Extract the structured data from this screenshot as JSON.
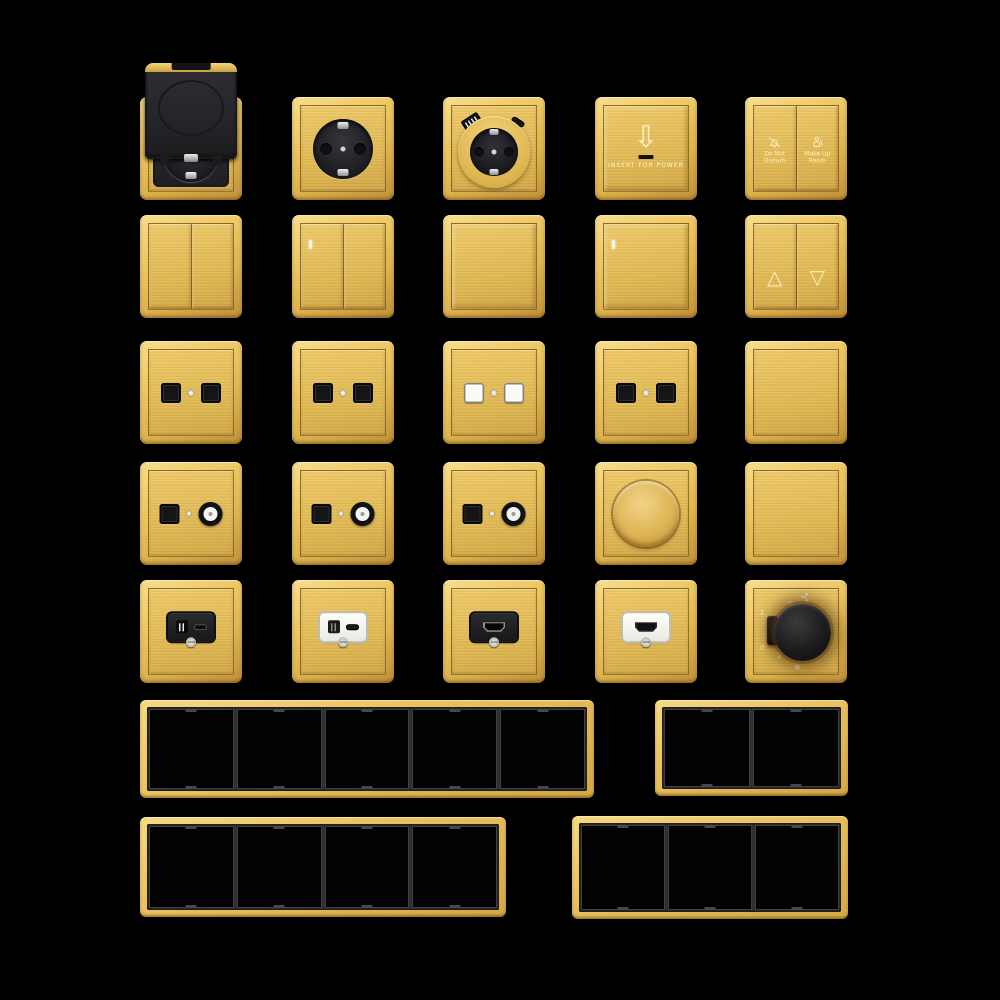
{
  "scene": {
    "background": "#000000"
  },
  "palette": {
    "gold_light": "#f6d87e",
    "gold": "#e3bc57",
    "gold_deep": "#c39539",
    "part_black": "#1c1c1e",
    "part_white": "#f5f5f2",
    "frame_divider": "#303033"
  },
  "products": {
    "row1": [
      {
        "id": "flip-cover-socket"
      },
      {
        "id": "schuko-socket"
      },
      {
        "id": "schuko-usb-socket"
      },
      {
        "id": "key-card-power-switch"
      },
      {
        "id": "hotel-service-switch"
      }
    ],
    "row2": [
      {
        "id": "double-rocker-switch"
      },
      {
        "id": "double-rocker-switch-led"
      },
      {
        "id": "single-rocker-switch"
      },
      {
        "id": "single-rocker-switch-led"
      },
      {
        "id": "curtain-switch"
      }
    ],
    "row3": [
      {
        "id": "dual-data-socket-black"
      },
      {
        "id": "dual-data-socket-black"
      },
      {
        "id": "dual-data-socket-white"
      },
      {
        "id": "dual-data-socket-black"
      },
      {
        "id": "blank-plate"
      }
    ],
    "row4": [
      {
        "id": "data-tv-socket"
      },
      {
        "id": "data-tv-socket"
      },
      {
        "id": "data-tv-socket"
      },
      {
        "id": "rotary-dimmer"
      },
      {
        "id": "blank-plate"
      }
    ],
    "row5": [
      {
        "id": "usb-charger-socket-black"
      },
      {
        "id": "usb-charger-socket-white"
      },
      {
        "id": "hdmi-socket-black"
      },
      {
        "id": "hdmi-socket-white"
      },
      {
        "id": "fan-speed-controller"
      }
    ],
    "frames": [
      {
        "id": "frame-5-gang",
        "gangs": 5
      },
      {
        "id": "frame-2-gang",
        "gangs": 2
      },
      {
        "id": "frame-4-gang",
        "gangs": 4
      },
      {
        "id": "frame-3-gang",
        "gangs": 3
      }
    ]
  },
  "text": {
    "key_card": {
      "arrow": "⇩",
      "label": "INSERT FOR POWER"
    },
    "hotel": {
      "left": "Do Not Disturb",
      "right": "Make Up Room"
    },
    "curtain": {
      "up": "△",
      "down": "▽"
    },
    "fan": {
      "on": "1",
      "off": "0",
      "s2": "2",
      "s3": "3",
      "s4": "4",
      "s5": "5",
      "snow": "❄"
    }
  }
}
